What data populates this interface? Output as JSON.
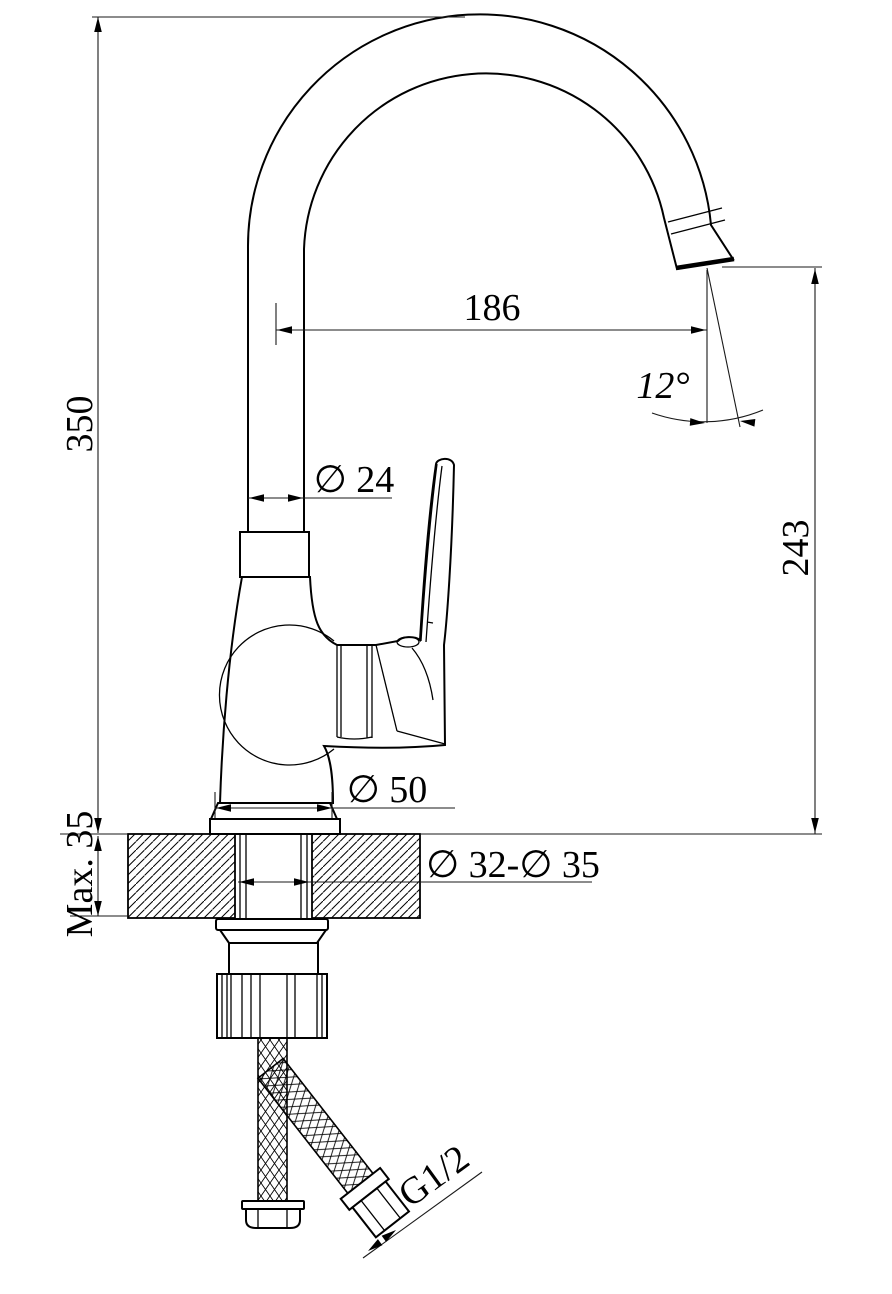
{
  "drawing": {
    "type": "technical-drawing",
    "subject": "single-lever kitchen mixer tap installation dimensions",
    "colors": {
      "line": "#000000",
      "dimension_line": "#1a1a1a",
      "background": "#ffffff"
    },
    "dimensions": {
      "overall_height": "350",
      "deck_thickness": "Max. 35",
      "spout_reach": "186",
      "spout_angle": "12°",
      "outlet_height": "243",
      "column_diameter": "∅ 24",
      "base_diameter": "∅ 50",
      "mounting_hole": "∅ 32-∅ 35",
      "connection_thread": "G1/2"
    }
  }
}
